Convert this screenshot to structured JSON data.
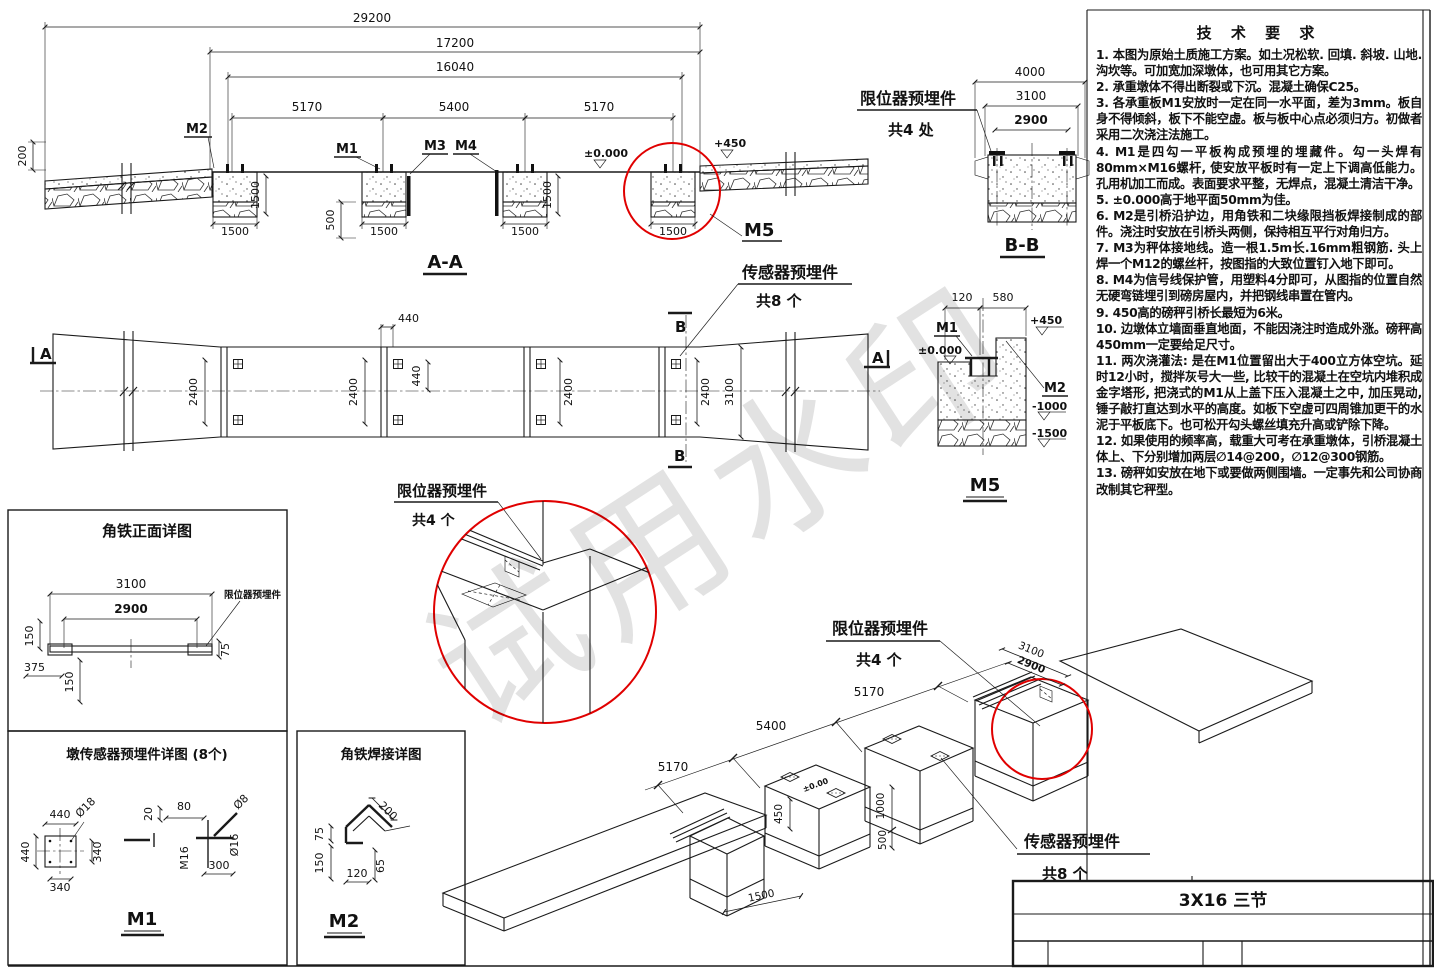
{
  "watermark": "试用水印",
  "tech": {
    "title": "技 术 要 求",
    "lines": [
      "1. 本图为原始土质施工方案。如土况松软. 回填. 斜坡. 山地. 沟坎等。可加宽加深墩体，也可用其它方案。",
      "2. 承重墩体不得出断裂或下沉。混凝土确保C25。",
      "3. 各承重板M1安放时一定在同一水平面，差为3mm。板自身不得倾斜，板下不能空虚。板与板中心点必须归方。初做者采用二次浇注法施工。",
      "4. M1是四勾一平板构成预埋的埋藏件。勾一头焊有80mm×M16螺杆, 使安放平板时有一定上下调高低能力。孔用机加工而成。表面要求平整，无焊点，混凝土清洁干净。",
      "5. ±0.000高于地平面50mm为佳。",
      "6. M2是引桥沿护边，用角铁和二块缘限挡板焊接制成的部件。浇注时安放在引桥头两侧，保持相互平行对角归方。",
      "7. M3为秤体接地线。造一根1.5m长.16mm粗钢筋. 头上焊一个M12的螺丝杆，按图指的大致位置钉入地下即可。",
      "8. M4为信号线保护管，用塑料4分即可，从图指的位置自然无硬弯链埋引到磅房屋内，并把钢线串置在管内。",
      "9. 450高的磅秤引桥长最短为6米。",
      "10. 边墩体立墙面垂直地面，不能因浇注时造成外涨。磅秤高450mm一定要给足尺寸。",
      "11. 两次浇灌法: 是在M1位置留出大于400立方体空坑。延时12小时，搅拌灰号大一些, 比较干的混凝土在空坑内堆积成金字塔形, 把浇式的M1从上盖下压入混凝土之中, 加压晃动, 锤子敲打直达到水平的高度。如板下空虚可四周锥加更干的水泥于平板底下。也可松开勾头螺丝填充升高或铲除下降。",
      "12. 如果使用的频率高，载重大可考在承重墩体，引桥混凝土体上、下分别增加两层∅14@200，∅12@300钢筋。",
      "13. 磅秤如安放在地下或要做两侧围墙。一定事先和公司协商改制其它秤型。"
    ]
  },
  "section_aa": {
    "title": "A-A",
    "dim_29200": "29200",
    "dim_17200": "17200",
    "dim_16040": "16040",
    "dim_5170": "5170",
    "dim_5400": "5400",
    "dim_200": "200",
    "dim_1500": "1500",
    "dim_500": "500",
    "label_m1": "M1",
    "label_m2": "M2",
    "label_m3": "M3",
    "label_m4": "M4",
    "label_m5": "M5",
    "level_zero": "±0.000",
    "level_450": "+450"
  },
  "section_bb": {
    "title": "B-B",
    "dim_4000": "4000",
    "dim_3100": "3100",
    "dim_2900": "2900",
    "callout": "限位器预埋件",
    "callout_count": "共4 处"
  },
  "detail_m5": {
    "title": "M5",
    "dim_120": "120",
    "dim_580": "580",
    "label_m1": "M1",
    "label_m2": "M2",
    "level_zero": "±0.000",
    "level_450": "+450",
    "level_m1000": "-1000",
    "level_m1500": "-1500"
  },
  "plan": {
    "mark_a": "A",
    "mark_b": "B",
    "dim_440": "440",
    "dim_2400": "2400",
    "dim_3100": "3100",
    "sensor_callout": "传感器预埋件",
    "sensor_count": "共8 个"
  },
  "limiter_detail": {
    "callout": "限位器预埋件",
    "count": "共4 个"
  },
  "detail_angle_front": {
    "title": "角铁正面详图",
    "dim_3100": "3100",
    "dim_2900": "2900",
    "dim_150": "150",
    "dim_375": "375",
    "dim_75": "75",
    "callout": "限位器预埋件"
  },
  "detail_pier_sensor": {
    "title": "墩传感器预埋件详图 (8个)",
    "dim_440": "440",
    "dim_340": "340",
    "dim_20": "20",
    "dim_80": "80",
    "dim_300": "300",
    "dia_18": "Ø18",
    "dia_16": "Ø16",
    "dia_8": "Ø8",
    "thread": "M16",
    "title_mark": "M1"
  },
  "detail_angle_weld": {
    "title": "角铁焊接详图",
    "dim_200": "200",
    "dim_75": "75",
    "dim_150": "150",
    "dim_120": "120",
    "dim_65": "65",
    "title_mark": "M2"
  },
  "isometric": {
    "dim_5170": "5170",
    "dim_5400": "5400",
    "dim_3100": "3100",
    "dim_2900": "2900",
    "dim_450": "450",
    "dim_1000": "1000",
    "dim_500": "500",
    "dim_1500": "1500",
    "level_zero": "±0.00",
    "limiter_callout": "限位器预埋件",
    "limiter_count": "共4 个",
    "sensor_callout": "传感器预埋件",
    "sensor_count": "共8 个"
  },
  "title_block": {
    "model": "3X16 三节"
  },
  "colors": {
    "line": "#1a1a1a",
    "highlight": "#e00000",
    "paper": "#ffffff"
  }
}
